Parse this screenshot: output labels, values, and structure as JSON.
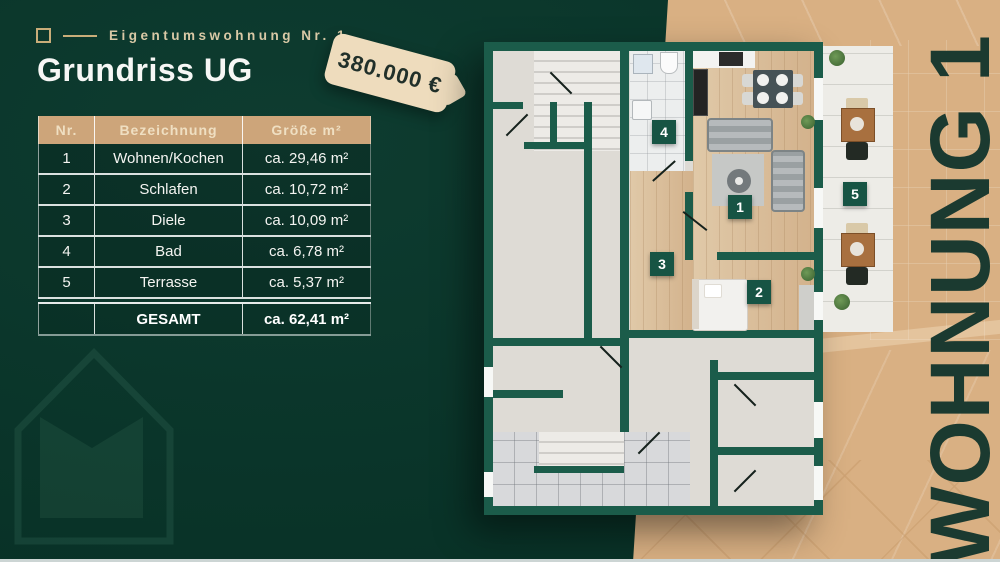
{
  "header": {
    "eyebrow_label": "Eigentumswohnung Nr. 1",
    "title": "Grundriss UG",
    "price_tag_label": "380.000 €"
  },
  "table": {
    "headers": {
      "nr": "Nr.",
      "name": "Bezeichnung",
      "size": "Größe m²"
    },
    "rows": [
      {
        "nr": "1",
        "name": "Wohnen/Kochen",
        "size": "ca. 29,46 m²"
      },
      {
        "nr": "2",
        "name": "Schlafen",
        "size": "ca. 10,72 m²"
      },
      {
        "nr": "3",
        "name": "Diele",
        "size": "ca. 10,09 m²"
      },
      {
        "nr": "4",
        "name": "Bad",
        "size": "ca. 6,78 m²"
      },
      {
        "nr": "5",
        "name": "Terrasse",
        "size": "ca. 5,37 m²"
      }
    ],
    "total": {
      "label": "GESAMT",
      "size": "ca. 62,41 m²"
    }
  },
  "floorplan": {
    "badges": {
      "living": "1",
      "bedroom": "2",
      "hall": "3",
      "bath": "4",
      "terrace": "5"
    }
  },
  "side_panel": {
    "vertical_label": "WOHNUNG 1"
  },
  "colors": {
    "background_green": "#093328",
    "wall_green": "#1b5c4a",
    "accent_tan": "#cda57a",
    "panel_tan": "#d9b083",
    "tag_cream": "#eedcbd"
  }
}
